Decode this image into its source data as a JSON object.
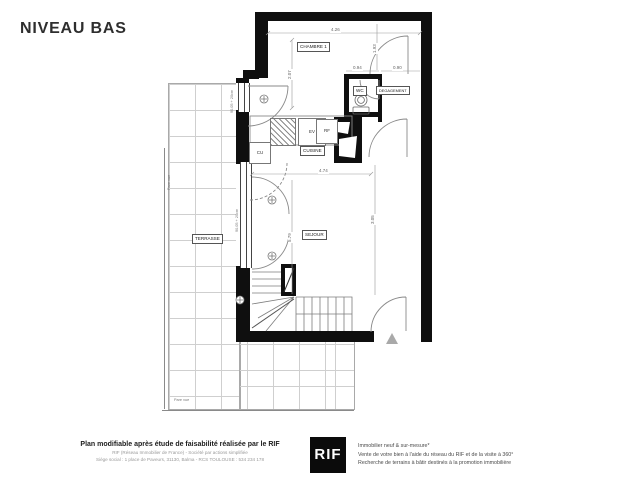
{
  "page": {
    "title": "NIVEAU BAS"
  },
  "plan": {
    "rooms": {
      "chambre1": "CHAMBRE 1",
      "wc": "WC",
      "degagement": "DEGAGEMENT",
      "cuisine": "CUISINE",
      "sejour": "SEJOUR",
      "terrasse": "TERRASSE"
    },
    "fixtures": {
      "ev": "EV",
      "rf": "RF",
      "cu": "CU"
    },
    "dimensions": {
      "top_width": "4.26",
      "chambre_height": "2.07",
      "chambre_right": "1.93",
      "wc_width": "0.94",
      "degagement_width": "0.90",
      "sejour_width": "4.74",
      "sejour_height": "5.79",
      "sejour_right": "3.05"
    },
    "annotations": {
      "pare_vue_side": "Pare vue",
      "pare_vue_bottom": "Pare vue",
      "window_note_chambre": "90.05 + 20cm",
      "window_note_sejour": "90.05 + 20cm"
    },
    "colors": {
      "wall": "#0f0f0f",
      "grid_line": "#cfcfcf",
      "dim_line": "#999999"
    }
  },
  "footer": {
    "left": {
      "headline": "Plan modifiable après étude de faisabilité réalisée par le RIF",
      "line2": "RIF (Réseau Immobilier de France) - Société par actions simplifiée",
      "line3": "Siège social : 1 place de Paveurs, 31130, Balma - RCS TOULOUSE : 534 234 178"
    },
    "logo": {
      "text": "RIF"
    },
    "right": {
      "line1": "Immobilier neuf & sur-mesure*",
      "line2": "Vente de votre bien à l'aide du réseau du RIF et de la visite à 360°",
      "line3": "Recherche de terrains à bâtir destinés à la promotion immobilière"
    }
  }
}
